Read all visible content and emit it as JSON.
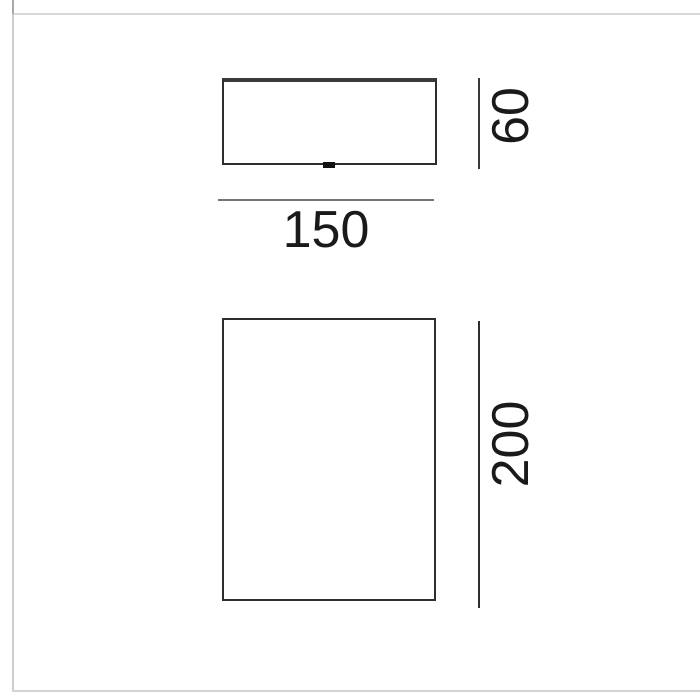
{
  "diagram": {
    "kind": "product-dimension-drawing",
    "width_label": "150",
    "top_view": {
      "name": "top-view",
      "height_label": "60"
    },
    "front_view": {
      "name": "front-view",
      "height_label": "200"
    }
  },
  "colors": {
    "outline": "#2e2e2e",
    "outline_top_edge": "#3a3a3a",
    "dimension_line": "#757575",
    "dimension_text": "#1a1a1a",
    "frame_border": "#cfcfcf",
    "background": "#ffffff"
  }
}
